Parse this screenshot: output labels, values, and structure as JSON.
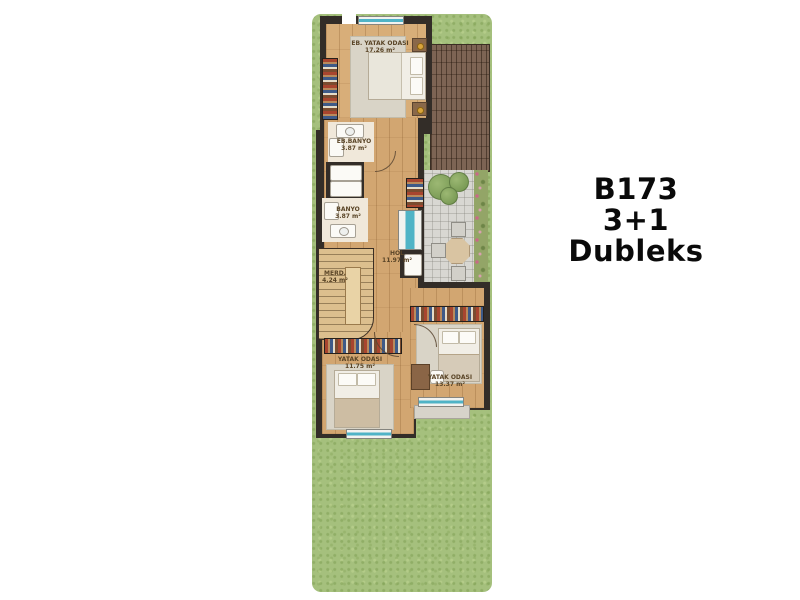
{
  "title_block": {
    "model": "B173",
    "layout": "3+1",
    "type": "Dubleks"
  },
  "rooms": [
    {
      "id": "master-bedroom",
      "name": "EB. YATAK ODASI",
      "area": "17.26 m²"
    },
    {
      "id": "master-bathroom",
      "name": "EB.BANYO",
      "area": "3.87 m²"
    },
    {
      "id": "bathroom",
      "name": "BANYO",
      "area": "3.87 m²"
    },
    {
      "id": "hall",
      "name": "HOL",
      "area": "11.97 m²"
    },
    {
      "id": "stairs",
      "name": "MERD.",
      "area": "4.24 m²"
    },
    {
      "id": "bedroom-2",
      "name": "YATAK ODASI",
      "area": "11.75 m²"
    },
    {
      "id": "bedroom-3",
      "name": "YATAK ODASI",
      "area": "13.37 m²"
    }
  ],
  "colors": {
    "grass": "#a5c07d",
    "deck_wood": "#7d6454",
    "wall": "#332d28",
    "floor_wood": "#d2a671",
    "bath_floor": "#f0e8da",
    "carpet": "#d9d4c7",
    "paving": "#d8d7d2",
    "window_glass": "#4fb3c6",
    "label_text": "#5a4527",
    "title_text": "#0a0a0a"
  }
}
